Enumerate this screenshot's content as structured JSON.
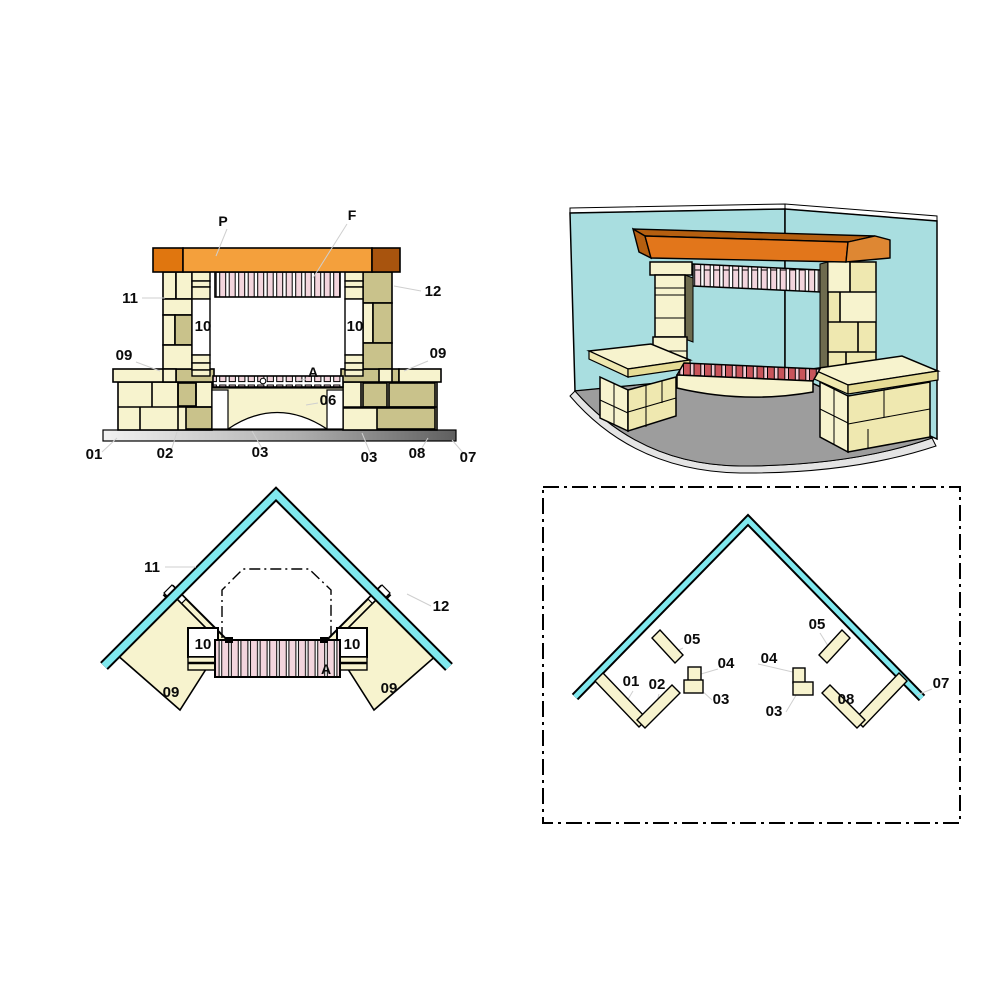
{
  "diagram": {
    "title": "Corner fireplace assembly diagram",
    "views": {
      "front_elevation": {
        "name": "Front elevation",
        "labels": {
          "p": "P",
          "f": "F",
          "n11": "11",
          "n12": "12",
          "n10_left": "10",
          "n10_right": "10",
          "n09_left": "09",
          "n09_right": "09",
          "a": "A",
          "n06": "06",
          "n01": "01",
          "n02": "02",
          "n03_left": "03",
          "n03_right": "03",
          "n08": "08",
          "n07": "07"
        }
      },
      "isometric": {
        "name": "3D corner view"
      },
      "plan": {
        "name": "Plan view",
        "labels": {
          "n11": "11",
          "n12": "12",
          "n10_left": "10",
          "n10_right": "10",
          "a": "A",
          "n09_left": "09",
          "n09_right": "09"
        }
      },
      "foundation": {
        "name": "Foundation layout",
        "labels": {
          "n05_left": "05",
          "n05_right": "05",
          "n04_left": "04",
          "n04_right": "04",
          "n01": "01",
          "n02": "02",
          "n03_left": "03",
          "n03_right": "03",
          "n08": "08",
          "n07": "07"
        }
      }
    },
    "colors": {
      "stone_cream": "#F7F3CE",
      "stone_khaki": "#C9C28B",
      "mantel_orange": "#F4A03C",
      "mantel_dark_orange": "#E0760F",
      "mantel_brown": "#A8540E",
      "brick_pink": "#F3D5DD",
      "brick_red": "#C8545A",
      "wall_cyan_3d": "#A9DEE0",
      "wall_cyan_plan": "#7FE8EE",
      "floor_gray": "#9D9D9D"
    }
  }
}
